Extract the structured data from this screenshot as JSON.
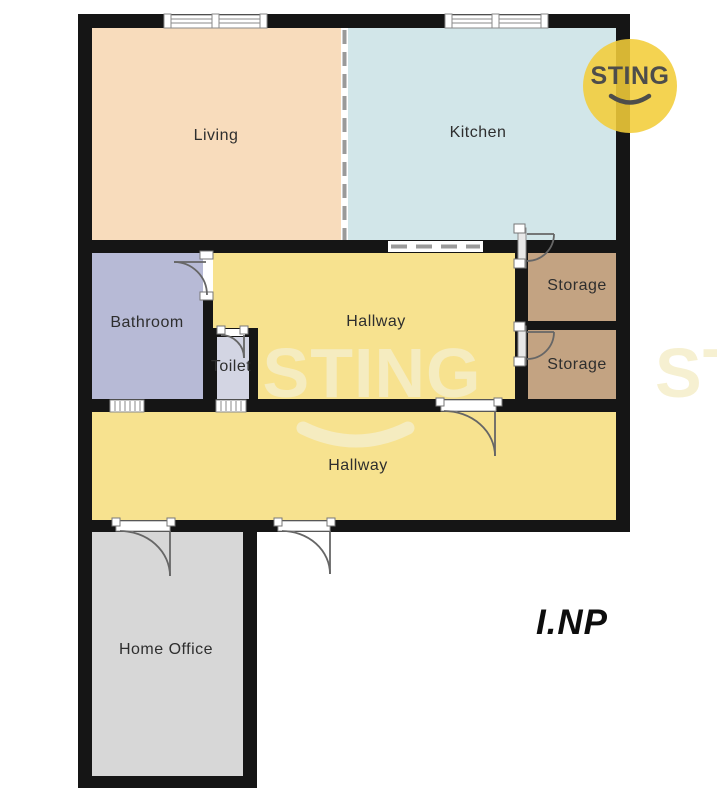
{
  "plan": {
    "rooms": [
      {
        "id": "living",
        "label": "Living"
      },
      {
        "id": "kitchen",
        "label": "Kitchen"
      },
      {
        "id": "bathroom",
        "label": "Bathroom"
      },
      {
        "id": "toilet",
        "label": "Toilet"
      },
      {
        "id": "hallway-middle",
        "label": "Hallway"
      },
      {
        "id": "storage-1",
        "label": "Storage"
      },
      {
        "id": "storage-2",
        "label": "Storage"
      },
      {
        "id": "hallway-lower",
        "label": "Hallway"
      },
      {
        "id": "home-office",
        "label": "Home Office"
      }
    ],
    "floor_label": "I.NP"
  },
  "branding": {
    "logo_text": "STING",
    "watermark_text": "STING",
    "logo_circle_color": "#F3CD39",
    "logo_text_color": "#4D4D4B"
  },
  "colors": {
    "living": "#F8DCBC",
    "kitchen": "#D2E6E9",
    "bathroom": "#B7BAD6",
    "toilet": "#D3D5E3",
    "hallway": "#F7E28F",
    "storage": "#C3A382",
    "home_office": "#D7D7D7",
    "wall": "#151515",
    "watermark": "#F5EEC9"
  }
}
